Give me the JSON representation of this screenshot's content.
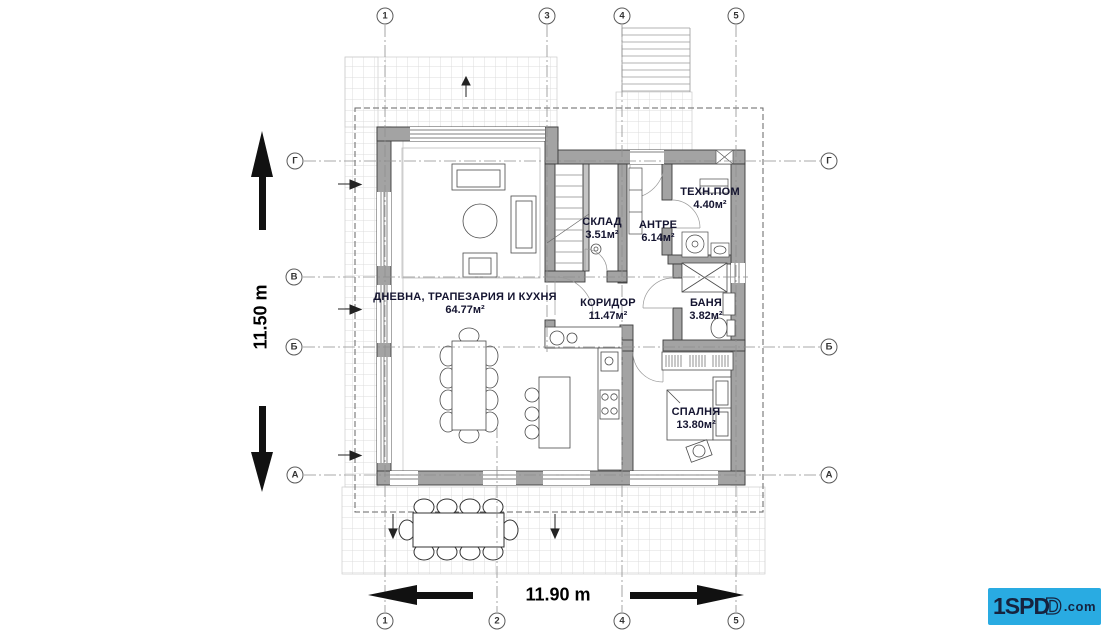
{
  "rooms": {
    "living": {
      "name": "ДНЕВНА, ТРАПЕЗАРИЯ И КУХНЯ",
      "area": "64.77м²"
    },
    "storage": {
      "name": "СКЛАД",
      "area": "3.51м²"
    },
    "entry": {
      "name": "АНТРЕ",
      "area": "6.14м²"
    },
    "tech": {
      "name": "ТЕХН.ПОМ",
      "area": "4.40м²"
    },
    "corridor": {
      "name": "КОРИДОР",
      "area": "11.47м²"
    },
    "bath": {
      "name": "БАНЯ",
      "area": "3.82м²"
    },
    "bedroom": {
      "name": "СПАЛНЯ",
      "area": "13.80м²"
    }
  },
  "dimensions": {
    "vertical": "11.50 m",
    "horizontal": "11.90 m"
  },
  "axes": {
    "top": [
      "1",
      "3",
      "4",
      "5"
    ],
    "bottom": [
      "1",
      "2",
      "4",
      "5"
    ],
    "left": [
      "Г",
      "В",
      "Б",
      "А"
    ],
    "right": [
      "Г",
      "Б",
      "А"
    ]
  },
  "logo": {
    "text_main": "1SPD",
    "text_overlap": "D",
    "text_domain": ".com"
  },
  "colors": {
    "wall": "#a3a3a3",
    "wall_light": "#c4c4c4",
    "line": "#4a4a4a",
    "grid": "#dcdcdc",
    "axis_line": "#8f8f8f",
    "label": "#141430",
    "logo_bg": "#29abe2",
    "logo_text": "#16233f"
  }
}
